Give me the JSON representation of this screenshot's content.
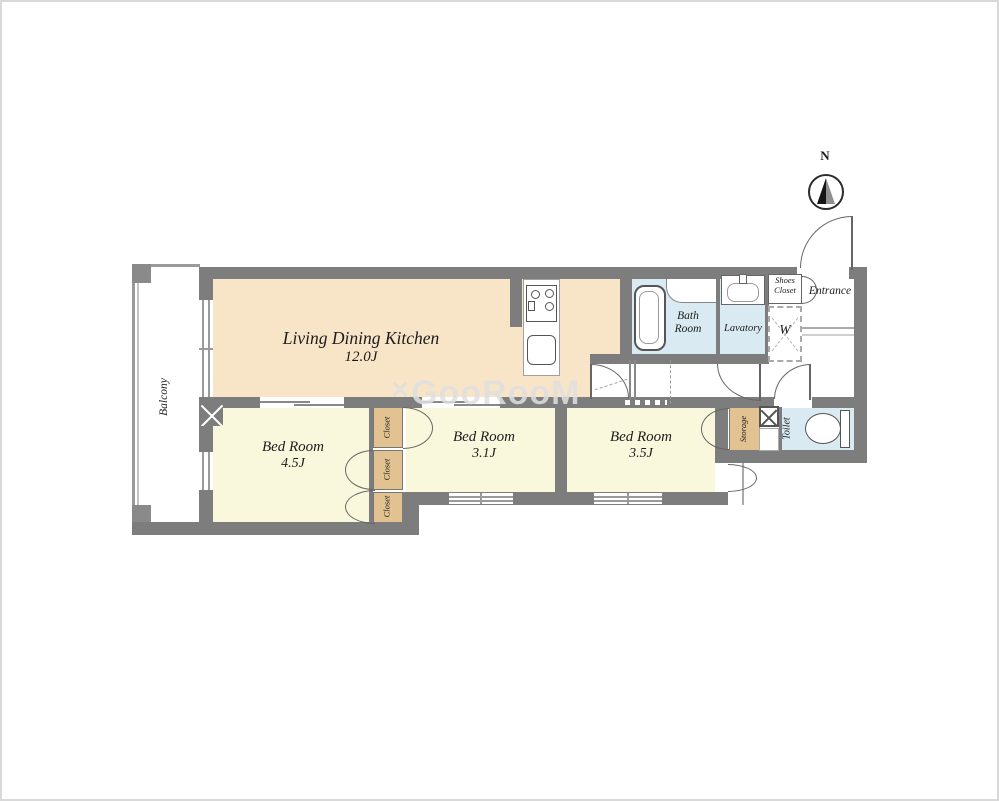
{
  "watermark": {
    "prefix": "✕",
    "text": "GooRooM"
  },
  "compass": {
    "north_label": "N"
  },
  "rooms": {
    "ldk": {
      "name": "Living Dining Kitchen",
      "size": "12.0J"
    },
    "bedroom_45": {
      "name": "Bed Room",
      "size": "4.5J"
    },
    "bedroom_31": {
      "name": "Bed Room",
      "size": "3.1J"
    },
    "bedroom_35": {
      "name": "Bed Room",
      "size": "3.5J"
    },
    "balcony": {
      "name": "Balcony"
    },
    "bath": {
      "line1": "Bath",
      "line2": "Room"
    },
    "lavatory": {
      "name": "Lavatory"
    },
    "toilet": {
      "name": "Toilet"
    },
    "storage": {
      "name": "Storage"
    },
    "entrance": {
      "name": "Entrance"
    },
    "shoes_closet": {
      "line1": "Shoes",
      "line2": "Closet"
    },
    "closet_a": {
      "name": "Closet"
    },
    "closet_b": {
      "name": "Closet"
    },
    "closet_c": {
      "name": "Closet"
    },
    "washer": {
      "label": "W"
    }
  },
  "colors": {
    "wall": "#7d7d7d",
    "ldk_fill": "#f8e5c8",
    "bedroom_fill": "#faf8dc",
    "closet_fill": "#e2c291",
    "wet_fill": "#d9eaf2",
    "watermark": "#e0e0e0"
  }
}
